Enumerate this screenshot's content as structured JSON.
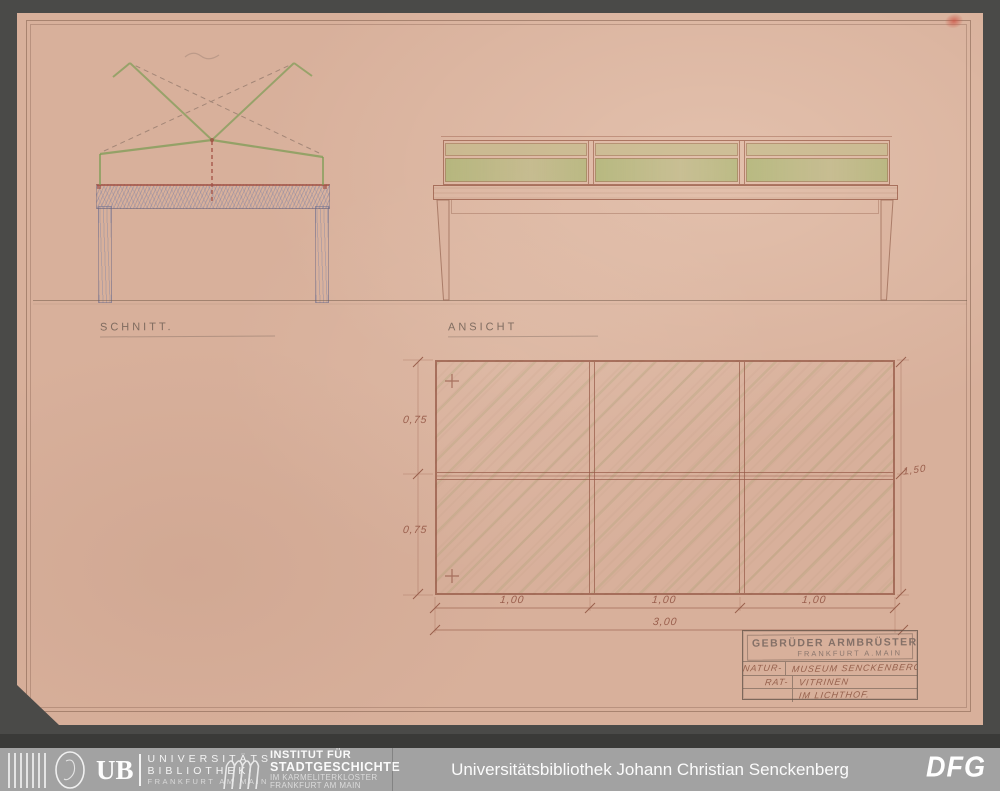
{
  "scan": {
    "labels": {
      "section": "SCHNITT.",
      "elevation": "ANSICHT"
    },
    "dims": {
      "v1": "0,75",
      "v2": "0,75",
      "b1": "1,00",
      "b2": "1,00",
      "b3": "1,00",
      "total_w": "3,00",
      "total_h": "1,50"
    },
    "title_block": {
      "firm": "GEBRÜDER ARMBRÜSTER",
      "city": "FRANKFURT A.MAIN",
      "rows": [
        {
          "left": "NATUR-",
          "right": "MUSEUM SENCKENBERG."
        },
        {
          "left": "RAT-",
          "right": "VITRINEN"
        },
        {
          "left": "",
          "right": "IM LICHTHOF."
        }
      ]
    }
  },
  "footer": {
    "ub": {
      "abbr": "UB",
      "line1": "UNIVERSITÄTS",
      "line2": "BIBLIOTHEK",
      "line3": "FRANKFURT AM MAIN"
    },
    "institut": {
      "line1": "INSTITUT FÜR",
      "line2": "STADTGESCHICHTE",
      "line3": "IM KARMELITERKLOSTER",
      "line4": "FRANKFURT AM MAIN"
    },
    "center_text": "Universitätsbibliothek Johann Christian Senckenberg",
    "dfg": "DFG"
  },
  "colors": {
    "background": "#4a4a48",
    "paper": "#d8b09b",
    "footer_bar": "#a2a2a2",
    "pencil_green": "#7d9c55",
    "pencil_red": "#a14f44",
    "pencil_blue": "#8b92b2",
    "ink_brown": "#9a5f4d"
  }
}
